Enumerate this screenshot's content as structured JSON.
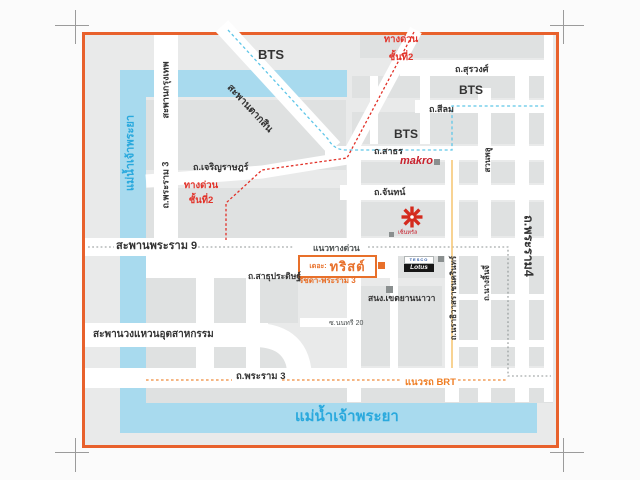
{
  "colors": {
    "frame": "#e8612c",
    "map_bg": "#e9eaea",
    "block": "#dfe1e1",
    "road": "#ffffff",
    "river": "#a8daee",
    "river_text": "#2aa9dd",
    "bts_line": "#5fc6e8",
    "expressway_red": "#e23128",
    "expressway_gray_dash": "#8f9595",
    "brt_orange": "#ef8b3a",
    "brt_yellow": "#f6c878",
    "accent_orange": "#e8702a",
    "makro_red": "#c8202c",
    "central_red": "#d42b1e",
    "text_dark": "#333333"
  },
  "labels": {
    "bts": "BTS",
    "expressway_l1": "ทางด่วน",
    "expressway_l2": "ชั้นที่2",
    "surawong": "ถ.สุรวงศ์",
    "silom": "ถ.สีลม",
    "sathorn": "ถ.สาธร",
    "chan": "ถ.จันทน์",
    "charoen_rat": "ถ.เจริญราษฎร์",
    "taksin_bridge": "สะพานตากสิน",
    "krungthep_bridge": "สะพานกรุงเทพ",
    "rama3": "ถ.พระราม 3",
    "rama4": "ถ.พระราม4",
    "rama9_bridge": "สะพานพระราม 9",
    "expressway_guide": "แนวทางด่วน",
    "suan_phlu": "สวนพลู",
    "narathiwas": "ถ.นราธิวาสราชนครินทร์",
    "nang_linchi": "ถ.นางลิ้นจี่",
    "sathupradit": "ถ.สาธุประดิษฐ์",
    "district_office": "สนง.เขตยานนาวา",
    "soi_nonsi20": "ซ.นนทรี 20",
    "industrial_ring": "สะพานวงแหวนอุตสาหกรรม",
    "brt_guide": "แนวรถ BRT",
    "chao_phraya": "แม่น้ำเจ้าพระยา",
    "ratchada_rama3": "รัชดา-พระราม 3"
  },
  "venue": {
    "prefix": "เดอะ:",
    "name": "ทริสต์"
  },
  "brands": {
    "makro": "makro",
    "tesco": "TESCO",
    "lotus": "Lotus",
    "central": "เซ็นทรัล"
  }
}
